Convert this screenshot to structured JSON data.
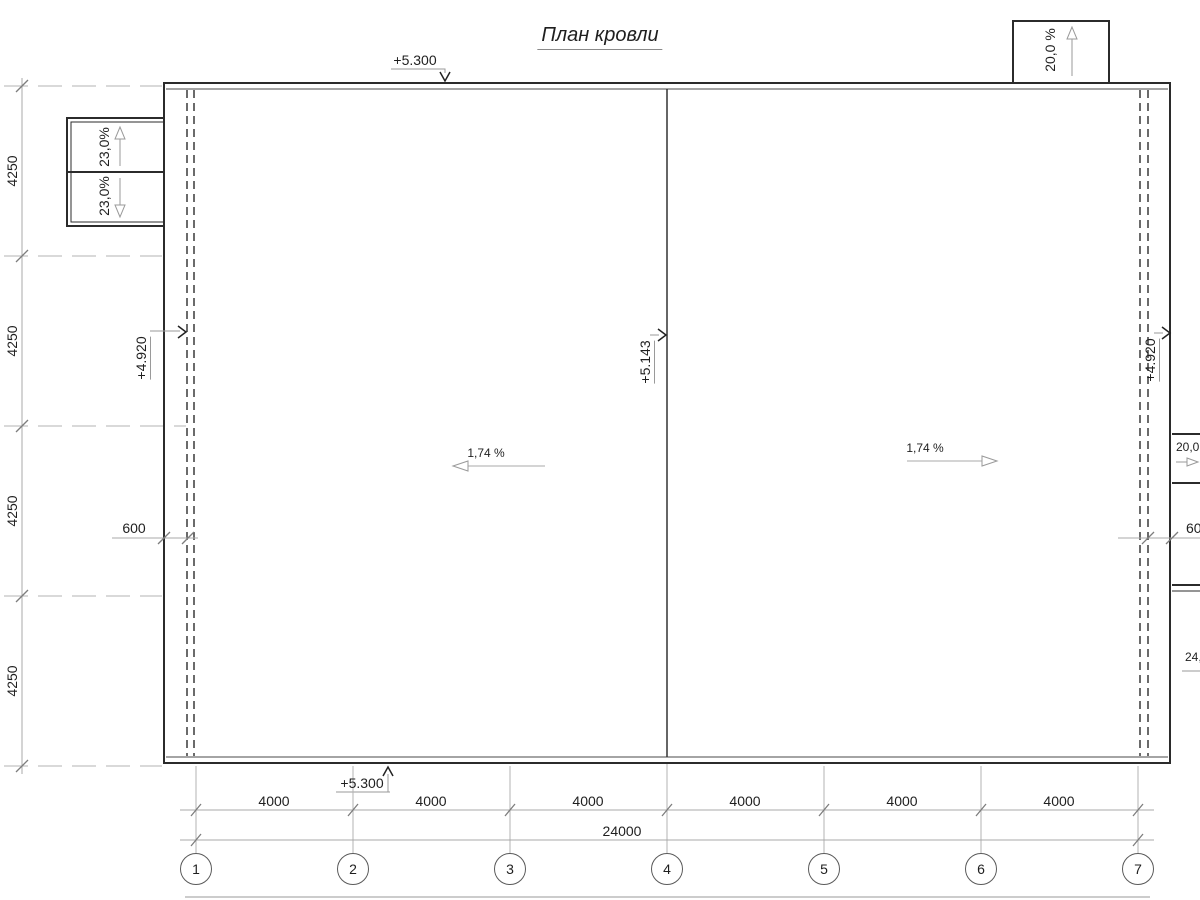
{
  "title": "План кровли",
  "elevations": {
    "top": "+5.300",
    "bottom": "+5.300",
    "left_eave": "+4.920",
    "ridge": "+5.143",
    "right_eave": "+4.920"
  },
  "slopes": {
    "left_roof": "1,74 %",
    "right_roof": "1,74 %",
    "top_right_canopy": "20,0 %",
    "top_left_canopy_upper": "23,0%",
    "top_left_canopy_lower": "23,0%",
    "right_canopy_upper": "20,0",
    "right_canopy_lower": "24,"
  },
  "dimensions": {
    "left_vertical": [
      "4250",
      "4250",
      "4250",
      "4250"
    ],
    "bottom_spans": [
      "4000",
      "4000",
      "4000",
      "4000",
      "4000",
      "4000"
    ],
    "bottom_total": "24000",
    "left_parapet": "600",
    "right_parapet": "600"
  },
  "axes": [
    "1",
    "2",
    "3",
    "4",
    "5",
    "6",
    "7"
  ],
  "colors": {
    "main_line": "#2b2b2b",
    "dim_line": "#a8a8a8",
    "text": "#1f1f1f"
  }
}
